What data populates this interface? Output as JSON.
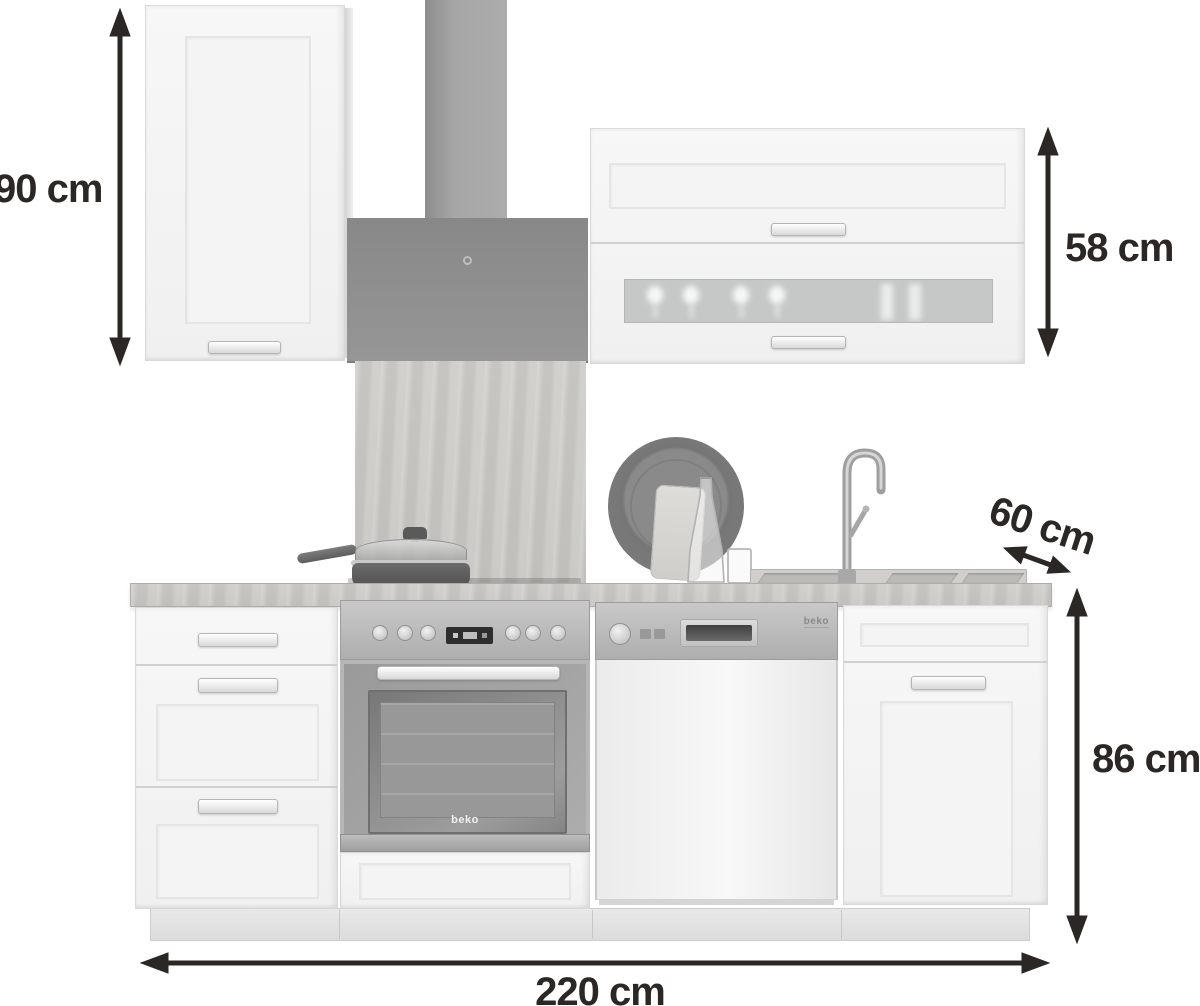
{
  "meta": {
    "description": "Kitchen unit with beko appliances, annotated with dimensions"
  },
  "annotations": {
    "wall_cabinet_height": {
      "label": "90 cm"
    },
    "upper_right_cabinet_height": {
      "label": "58 cm"
    },
    "depth": {
      "label": "60 cm"
    },
    "base_unit_height": {
      "label": "86 cm"
    },
    "total_width": {
      "label": "220 cm"
    }
  },
  "branding": {
    "oven_logo": "beko",
    "dishwasher_logo": "beko"
  },
  "colors": {
    "background": "#ffffff",
    "annotation_ink": "#2b2725",
    "cabinet_front": "#f3f3f3",
    "hood_gray": "#8e8e8e",
    "worktop_wood_gray": "#c9c8c4",
    "stainless_steel": "#b7b7b7"
  }
}
